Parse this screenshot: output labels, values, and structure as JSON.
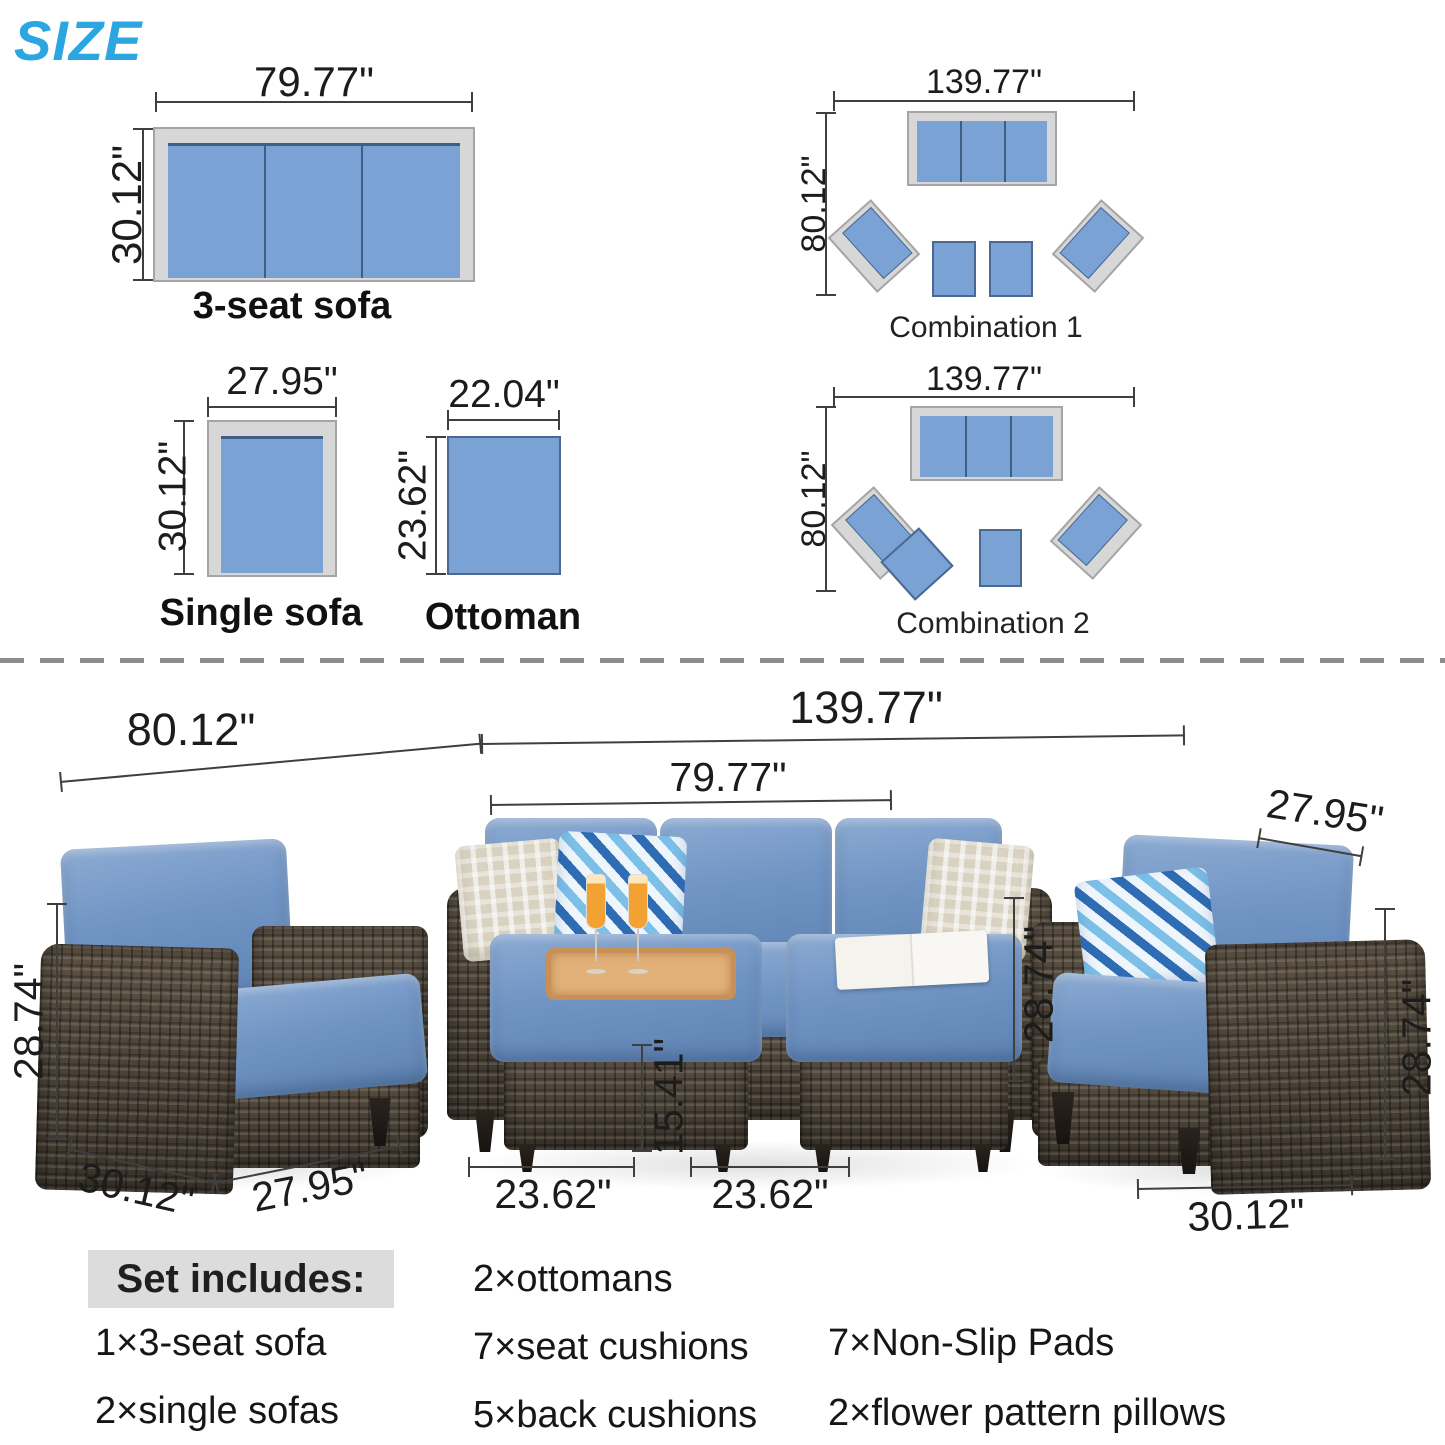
{
  "title": "SIZE",
  "colors": {
    "accent_blue": "#2ca6e0",
    "diagram_blue": "#7aa2d4",
    "diagram_frame_gray": "#d7d7d7",
    "cushion_blue": "#7094c4",
    "wicker_brown": "#483e34",
    "dimension_line": "#3f3f3f",
    "highlight_gray": "#dcdcdc"
  },
  "diagrams": {
    "sofa3": {
      "label": "3-seat sofa",
      "width": "79.77\"",
      "height": "30.12\""
    },
    "single": {
      "label": "Single sofa",
      "width": "27.95\"",
      "height": "30.12\""
    },
    "ottoman": {
      "label": "Ottoman",
      "width": "22.04\"",
      "height": "23.62\""
    },
    "combo1": {
      "label": "Combination 1",
      "width": "139.77\"",
      "depth": "80.12\""
    },
    "combo2": {
      "label": "Combination 2",
      "width": "139.77\"",
      "depth": "80.12\""
    }
  },
  "photo_dims": {
    "left_group_width": "80.12\"",
    "total_width": "139.77\"",
    "sofa_width": "79.77\"",
    "right_chair_width": "27.95\"",
    "left_chair_height": "28.74\"",
    "sofa_height": "28.74\"",
    "right_chair_height": "28.74\"",
    "ottoman_height": "15.41\"",
    "ottoman_left_width": "23.62\"",
    "ottoman_right_width": "23.62\"",
    "left_chair_depth": "30.12\"",
    "left_chair_front_width": "27.95\"",
    "right_chair_depth": "30.12\""
  },
  "set_includes": {
    "heading": "Set includes:",
    "col1": [
      "1×3-seat sofa",
      "2×single sofas"
    ],
    "col2": [
      "2×ottomans",
      "7×seat cushions",
      "5×back cushions"
    ],
    "col3": [
      "7×Non-Slip Pads",
      "2×flower pattern pillows"
    ]
  }
}
